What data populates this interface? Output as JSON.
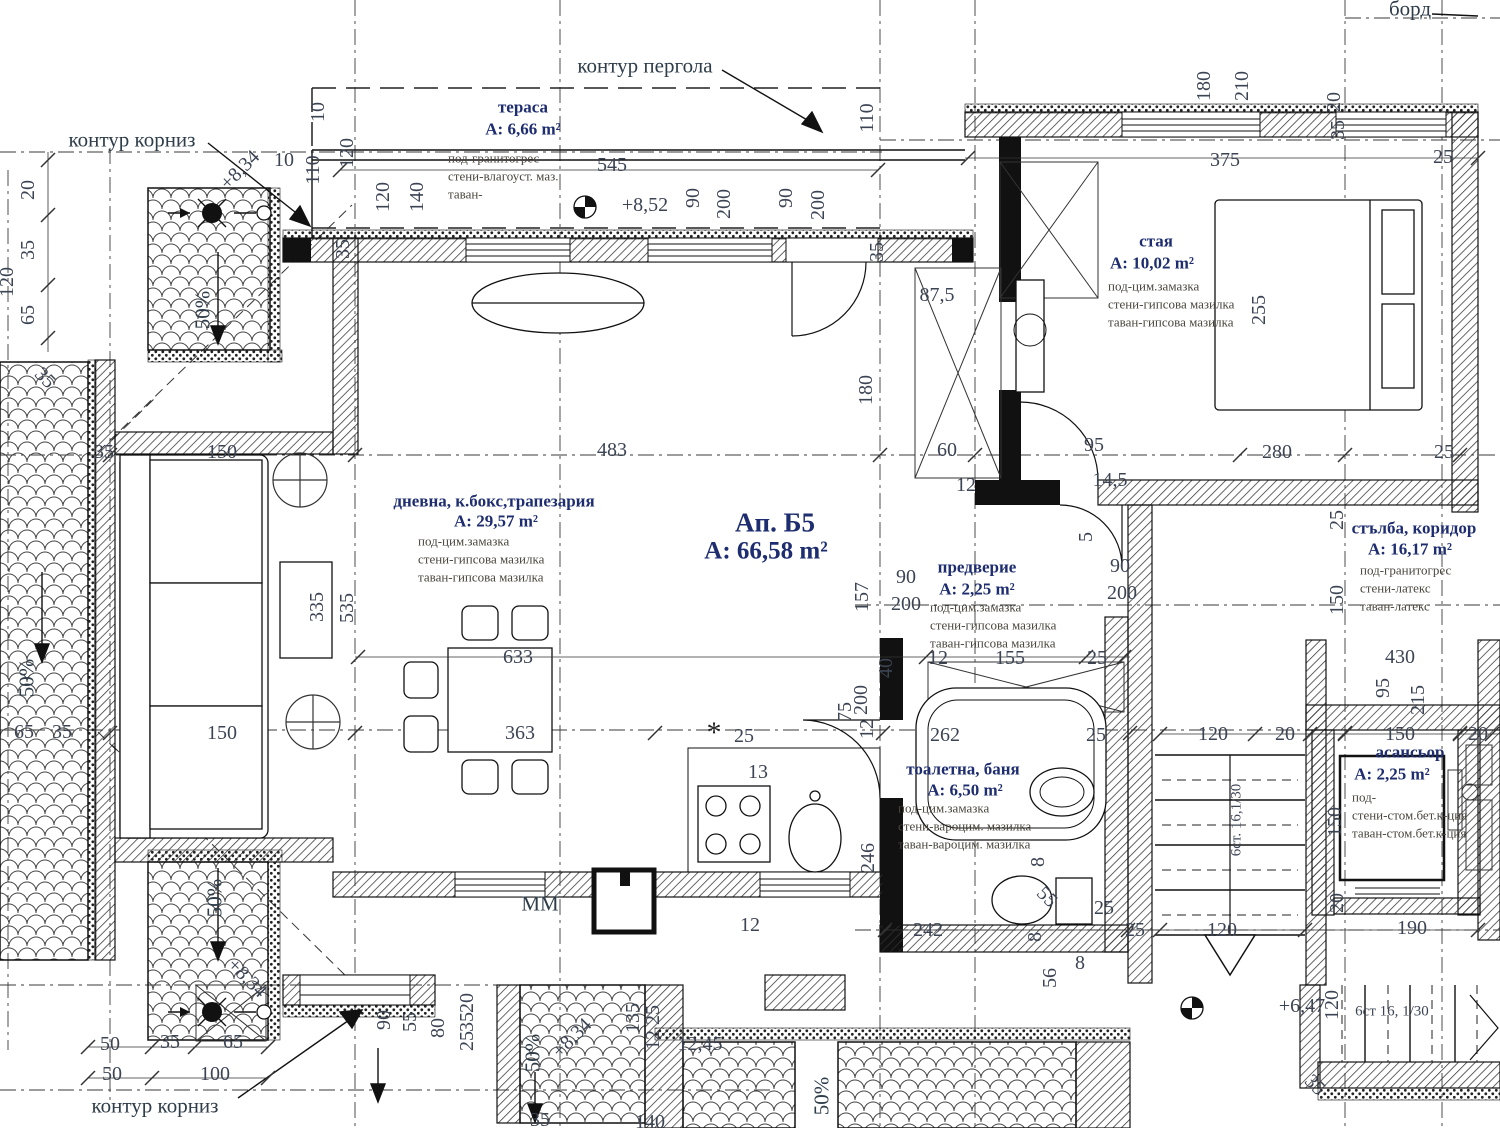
{
  "drawing": {
    "kind": "architectural floor plan",
    "sheet_edge": "борд"
  },
  "apartment": {
    "label": "Ап. Б5",
    "area": "A: 66,58 m²"
  },
  "colors": {
    "room_label": "#1e2d70",
    "finish_text": "#4a463c",
    "dimension_text": "#3c4454",
    "line": "#1a1a1a",
    "background": "#ffffff"
  },
  "rooms": [
    {
      "name": "тераса",
      "area": "A: 6,66 m²",
      "finishes": [
        "под-гранитогрес",
        "стени-влагоуст. маз.",
        "таван-"
      ],
      "pos": {
        "nx": 523,
        "ny": 107,
        "ax": 523,
        "ay": 129,
        "fx": 448,
        "fy": 158
      }
    },
    {
      "name": "стая",
      "area": "A: 10,02 m²",
      "finishes": [
        "под-цим.замазка",
        "стени-гипсова мазилка",
        "таван-гипсова мазилка"
      ],
      "pos": {
        "nx": 1156,
        "ny": 241,
        "ax": 1152,
        "ay": 263,
        "fx": 1108,
        "fy": 286
      }
    },
    {
      "name": "дневна, к.бокс,трапезария",
      "area": "A: 29,57 m²",
      "finishes": [
        "под-цим.замазка",
        "стени-гипсова мазилка",
        "таван-гипсова мазилка"
      ],
      "pos": {
        "nx": 494,
        "ny": 501,
        "ax": 496,
        "ay": 521,
        "fx": 418,
        "fy": 541
      }
    },
    {
      "name": "предверие",
      "area": "A: 2,25 m²",
      "finishes": [
        "под-цим.замазка",
        "стени-гипсова мазилка",
        "таван-гипсова мазилка"
      ],
      "pos": {
        "nx": 977,
        "ny": 567,
        "ax": 977,
        "ay": 589,
        "fx": 930,
        "fy": 607
      }
    },
    {
      "name": "тоалетна, баня",
      "area": "A: 6,50 m²",
      "finishes": [
        "под-цим.замазка",
        "стени-вароцим. мазилка",
        "таван-вароцим. мазилка"
      ],
      "pos": {
        "nx": 963,
        "ny": 769,
        "ax": 965,
        "ay": 790,
        "fx": 898,
        "fy": 808
      }
    },
    {
      "name": "стълба, коридор",
      "area": "A: 16,17 m²",
      "finishes": [
        "под-гранитогрес",
        "стени-латекс",
        "таван-латекс"
      ],
      "pos": {
        "nx": 1414,
        "ny": 528,
        "ax": 1410,
        "ay": 549,
        "fx": 1360,
        "fy": 570
      }
    },
    {
      "name": "асансьор",
      "area": "A: 2,25 m²",
      "finishes": [
        "под-",
        "стени-стом.бет.к-ция",
        "таван-стом.бет.к-ция"
      ],
      "pos": {
        "nx": 1410,
        "ny": 752,
        "ax": 1392,
        "ay": 774,
        "fx": 1352,
        "fy": 797
      }
    }
  ],
  "annotations": [
    [
      "контур пергола",
      645,
      66,
      0,
      "note"
    ],
    [
      "контур корниз",
      132,
      140,
      0,
      "note"
    ],
    [
      "контур корниз",
      155,
      1106,
      0,
      "note"
    ],
    [
      "борд",
      1410,
      9,
      0,
      "note"
    ],
    [
      "MM",
      540,
      904,
      0,
      "note"
    ],
    [
      "50%",
      203,
      310,
      -90,
      "note"
    ],
    [
      "50%",
      27,
      678,
      -90,
      "note"
    ],
    [
      "50%",
      215,
      898,
      -90,
      "note"
    ],
    [
      "50%",
      533,
      1053,
      -90,
      "note"
    ],
    [
      "50%",
      822,
      1096,
      -90,
      "note"
    ],
    [
      "+8,52",
      645,
      205,
      0,
      "dim"
    ],
    [
      "+8,34",
      240,
      170,
      -45,
      "dim"
    ],
    [
      "+8,34",
      247,
      978,
      45,
      "dim"
    ],
    [
      "+8,34",
      572,
      1038,
      -45,
      "dim"
    ],
    [
      "+6,47",
      1302,
      1006,
      0,
      "dim"
    ],
    [
      "6ст. 16,1/30",
      1237,
      820,
      -90,
      "small"
    ],
    [
      "6ст 16, 1/30",
      1392,
      1012,
      0,
      "small"
    ],
    [
      "*",
      714,
      733,
      0,
      "star"
    ]
  ],
  "dimensions": [
    [
      "545",
      612,
      165
    ],
    [
      "90",
      693,
      198,
      -90
    ],
    [
      "200",
      724,
      204,
      -90
    ],
    [
      "90",
      786,
      198,
      -90
    ],
    [
      "200",
      818,
      205,
      -90
    ],
    [
      "110",
      867,
      118,
      -90
    ],
    [
      "35",
      877,
      252,
      -90
    ],
    [
      "10",
      284,
      160
    ],
    [
      "110",
      313,
      170,
      -90
    ],
    [
      "10",
      318,
      112,
      -90
    ],
    [
      "120",
      347,
      153,
      -90
    ],
    [
      "120",
      383,
      197,
      -90
    ],
    [
      "140",
      417,
      197,
      -90
    ],
    [
      "35",
      343,
      249,
      -90
    ],
    [
      "180",
      1204,
      86,
      -90
    ],
    [
      "210",
      1242,
      86,
      -90
    ],
    [
      "20",
      1334,
      102,
      -90
    ],
    [
      "35",
      1338,
      130,
      -90
    ],
    [
      "375",
      1225,
      160
    ],
    [
      "25",
      1443,
      157
    ],
    [
      "87,5",
      937,
      295
    ],
    [
      "180",
      866,
      390,
      -90
    ],
    [
      "255",
      1259,
      310,
      -90
    ],
    [
      "280",
      1277,
      452
    ],
    [
      "25",
      1444,
      452
    ],
    [
      "95",
      1094,
      445
    ],
    [
      "14,5",
      1110,
      480
    ],
    [
      "60",
      947,
      450
    ],
    [
      "12",
      966,
      485
    ],
    [
      "483",
      612,
      450
    ],
    [
      "150",
      222,
      452
    ],
    [
      "35",
      104,
      452
    ],
    [
      "20",
      28,
      190,
      -90
    ],
    [
      "35",
      28,
      250,
      -90
    ],
    [
      "65",
      28,
      315,
      -90
    ],
    [
      "120",
      7,
      282,
      -90
    ],
    [
      "35",
      45,
      378,
      45
    ],
    [
      "150",
      222,
      733
    ],
    [
      "65",
      24,
      732
    ],
    [
      "35",
      62,
      732
    ],
    [
      "335",
      317,
      607,
      -90
    ],
    [
      "535",
      347,
      608,
      -90
    ],
    [
      "633",
      518,
      657
    ],
    [
      "363",
      520,
      733
    ],
    [
      "25",
      744,
      736
    ],
    [
      "13",
      758,
      772
    ],
    [
      "75",
      845,
      712,
      -90
    ],
    [
      "246",
      868,
      858,
      -90
    ],
    [
      "157",
      862,
      597,
      -90
    ],
    [
      "200",
      861,
      700,
      -90
    ],
    [
      "40",
      886,
      668,
      -90
    ],
    [
      "12",
      867,
      729,
      -90
    ],
    [
      "12",
      938,
      658
    ],
    [
      "155",
      1010,
      658
    ],
    [
      "25",
      1097,
      658
    ],
    [
      "90",
      906,
      577
    ],
    [
      "200",
      906,
      604
    ],
    [
      "90",
      1120,
      566
    ],
    [
      "200",
      1122,
      593
    ],
    [
      "5",
      1086,
      537,
      -90
    ],
    [
      "262",
      945,
      735
    ],
    [
      "25",
      1096,
      735
    ],
    [
      "242",
      928,
      930
    ],
    [
      "12",
      750,
      925
    ],
    [
      "8",
      1038,
      862,
      -90
    ],
    [
      "55",
      1047,
      897,
      45
    ],
    [
      "25",
      1104,
      908
    ],
    [
      "8",
      1035,
      937,
      -90
    ],
    [
      "8",
      1080,
      963
    ],
    [
      "56",
      1050,
      978,
      -90
    ],
    [
      "25",
      1135,
      930
    ],
    [
      "90",
      384,
      1020,
      -90
    ],
    [
      "55",
      410,
      1022,
      -90
    ],
    [
      "80",
      438,
      1028,
      -90
    ],
    [
      "20",
      467,
      1003,
      -90
    ],
    [
      "35",
      467,
      1022,
      -90
    ],
    [
      "25",
      467,
      1041,
      -90
    ],
    [
      "12,45",
      700,
      1044
    ],
    [
      "135",
      633,
      1018,
      -90
    ],
    [
      "25",
      653,
      1015,
      -90
    ],
    [
      "12",
      653,
      1040,
      -90
    ],
    [
      "35",
      540,
      1120
    ],
    [
      "140",
      650,
      1122
    ],
    [
      "50",
      110,
      1044
    ],
    [
      "35",
      170,
      1042
    ],
    [
      "65",
      233,
      1042
    ],
    [
      "50",
      112,
      1074
    ],
    [
      "100",
      215,
      1074
    ],
    [
      "120",
      1213,
      734
    ],
    [
      "20",
      1285,
      734
    ],
    [
      "150",
      1400,
      734
    ],
    [
      "20",
      1478,
      734
    ],
    [
      "25",
      1337,
      520,
      -90
    ],
    [
      "150",
      1337,
      600,
      -90
    ],
    [
      "430",
      1400,
      657
    ],
    [
      "95",
      1383,
      688,
      -90
    ],
    [
      "215",
      1418,
      700,
      -90
    ],
    [
      "150",
      1335,
      822,
      -90
    ],
    [
      "20",
      1337,
      903,
      -90
    ],
    [
      "120",
      1222,
      930
    ],
    [
      "190",
      1412,
      928
    ],
    [
      "120",
      1332,
      1005,
      -90
    ],
    [
      "35",
      1315,
      1085,
      45
    ]
  ]
}
